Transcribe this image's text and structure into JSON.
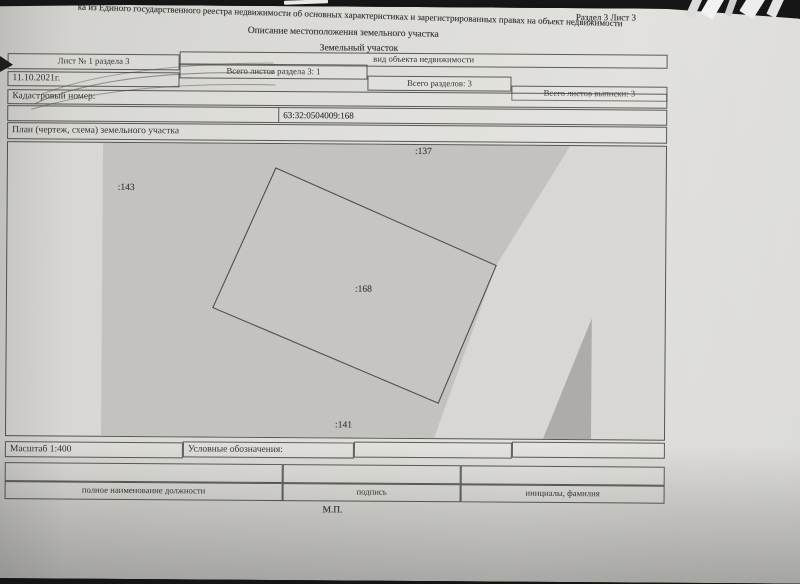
{
  "document": {
    "top_line": "ка из Единого государственного реестра недвижимости об основных характеристиках и зарегистрированных правах на объект недвижимости",
    "section_sheet": "Раздел 3   Лист 3",
    "title": "Описание местоположения земельного участка",
    "object_kind": "Земельный участок",
    "object_kind_caption": "вид объекта недвижимости",
    "sheet_no": "Лист № 1 раздела 3",
    "date": "11.10.2021г.",
    "total_sheets_section3": "Всего листов раздела 3: 1",
    "total_sections": "Всего разделов: 3",
    "total_extract_sheets": "Всего листов выписки: 3",
    "cadastral_label": "Кадастровый номер:",
    "cadastral_number": "63:32:0504009:168",
    "plan_title": "План (чертеж, схема) земельного участка"
  },
  "plan": {
    "parcel_labels": {
      "p137": ":137",
      "p143": ":143",
      "p168": ":168",
      "p141": ":141"
    },
    "colors": {
      "paper": "#dbdad6",
      "plan_background": "#d8d7d3",
      "neighbor_shade": "#c3c2be",
      "dark_shade": "#adacaa",
      "outline": "#4f4f4f"
    }
  },
  "footer": {
    "scale": "Масштаб 1:400",
    "legend": "Условные обозначения:",
    "position": "полное наименование должности",
    "signature": "подпись",
    "initials": "инициалы, фамилия",
    "stamp": "М.П."
  }
}
